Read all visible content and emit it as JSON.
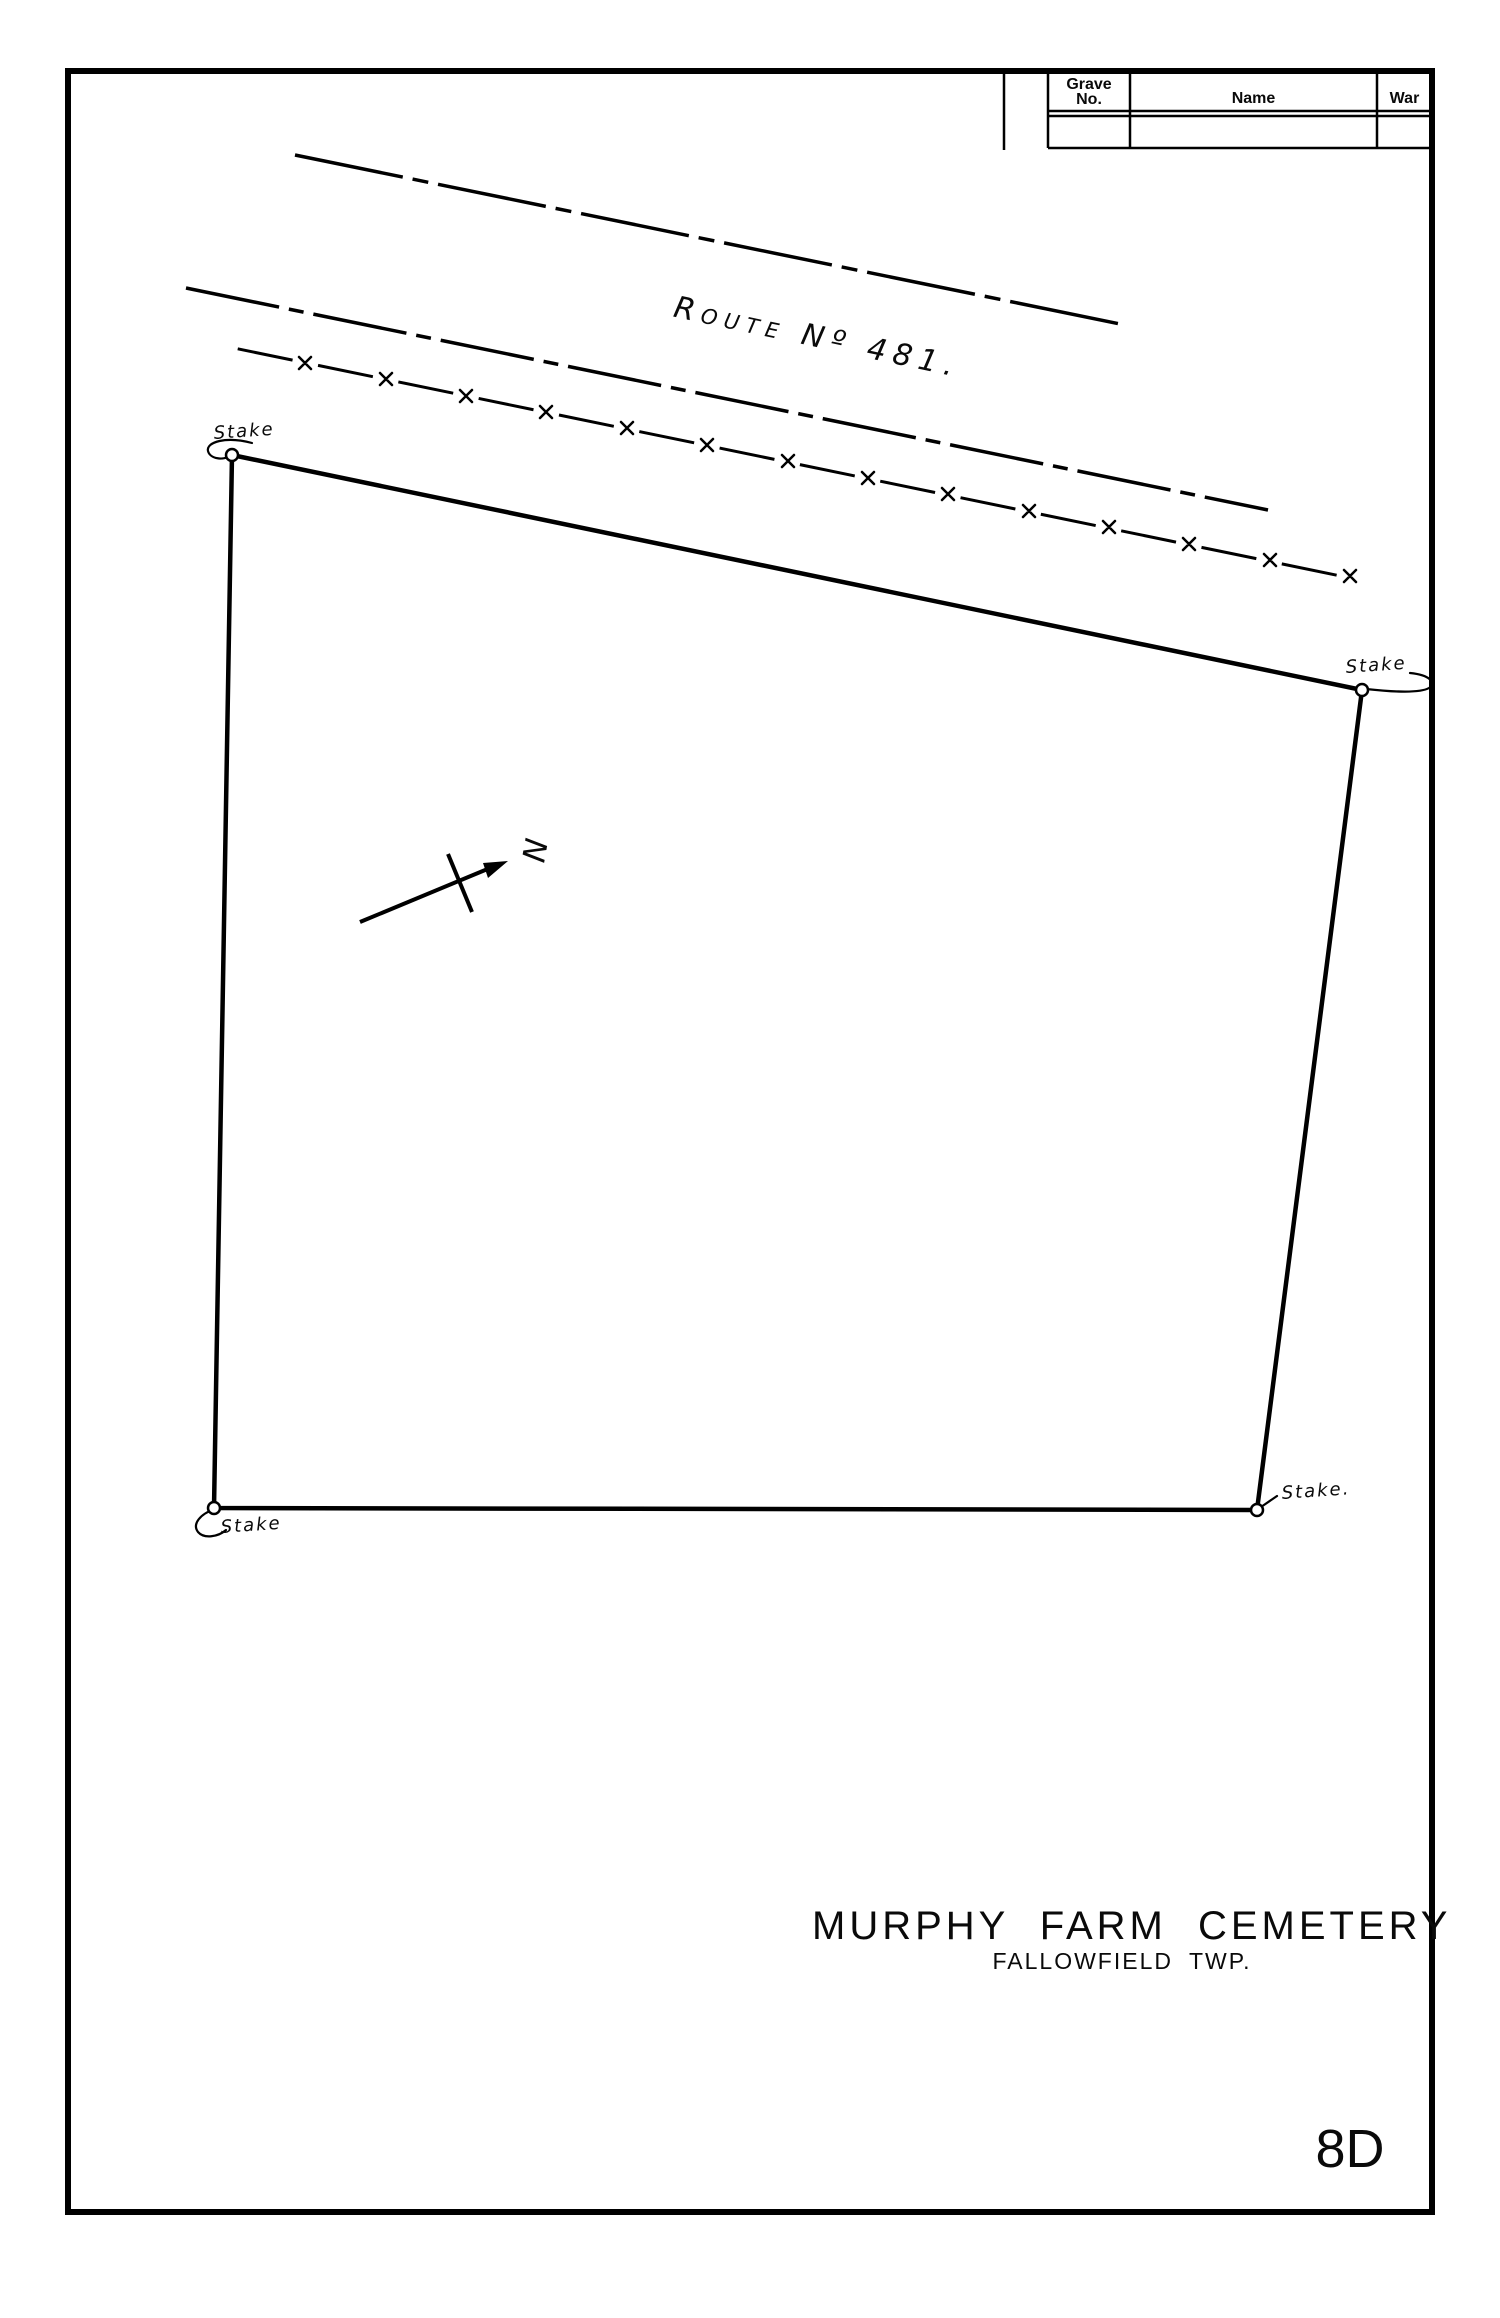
{
  "page": {
    "number": "8D",
    "ink_color": "#000000",
    "paper_color": "#ffffff"
  },
  "grave_table": {
    "headers": {
      "grave_line1": "Grave",
      "grave_line2": "No.",
      "name": "Name",
      "war": "War"
    },
    "rows": [
      {
        "grave_no": "",
        "name": "",
        "war": ""
      }
    ]
  },
  "road": {
    "label": "Route Nº 481."
  },
  "plot": {
    "stakes": {
      "top_left": "Stake",
      "top_right": "Stake",
      "bottom_right": "Stake.",
      "bottom_left": "Stake"
    },
    "north_label": "N"
  },
  "title_block": {
    "title": "MURPHY FARM CEMETERY",
    "subtitle": "FALLOWFIELD TWP."
  }
}
